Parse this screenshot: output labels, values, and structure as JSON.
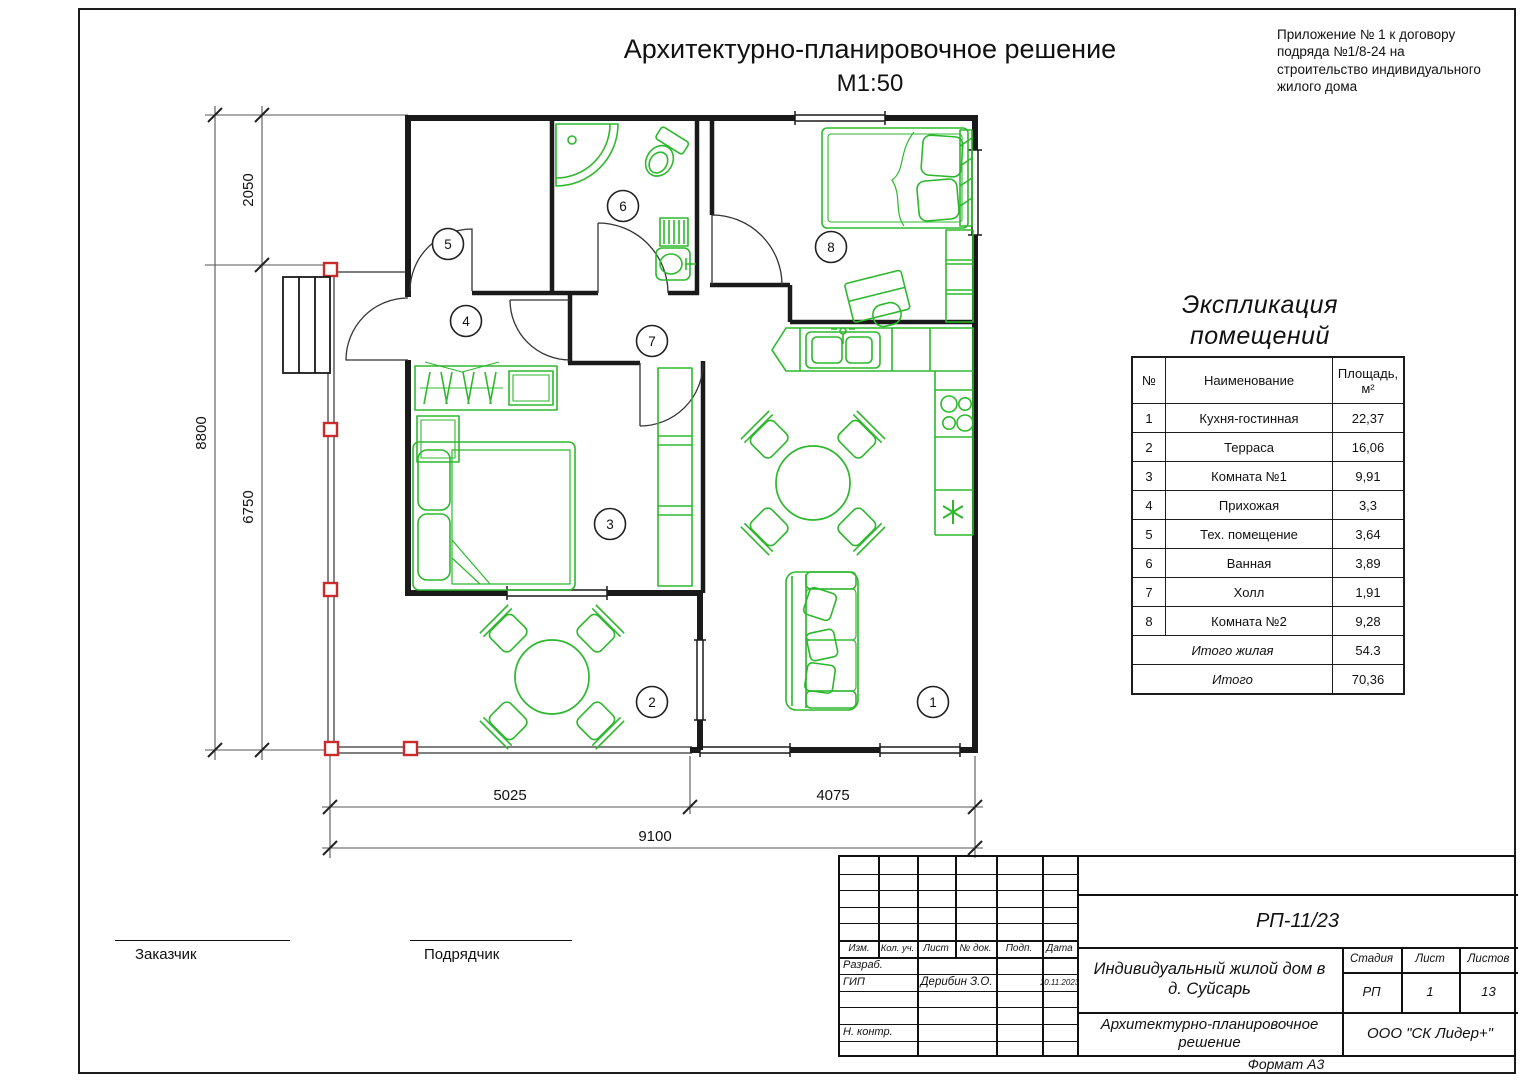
{
  "header": {
    "title": "Архитектурно-планировочное решение",
    "scale": "М1:50",
    "appendix_lines": [
      "Приложение № 1 к договору",
      "подряда №1/8-24  на",
      "строительство индивидуального",
      "жилого дома"
    ]
  },
  "plan": {
    "room_labels": [
      "1",
      "2",
      "3",
      "4",
      "5",
      "6",
      "7",
      "8"
    ],
    "dims": {
      "total_height": "8800",
      "upper": "2050",
      "lower": "6750",
      "bottom_left": "5025",
      "bottom_right": "4075",
      "bottom_total": "9100"
    },
    "colors": {
      "walls": "#1a1a1a",
      "furniture": "#2db82d",
      "posts": "#cc2a2a"
    }
  },
  "explication": {
    "title_lines": [
      "Экспликация",
      "помещений"
    ],
    "headers": {
      "num": "№",
      "name": "Наименование",
      "area1": "Площадь,",
      "area2": "м²"
    },
    "rows": [
      {
        "num": "1",
        "name": "Кухня-гостинная",
        "area": "22,37"
      },
      {
        "num": "2",
        "name": "Терраса",
        "area": "16,06"
      },
      {
        "num": "3",
        "name": "Комната №1",
        "area": "9,91"
      },
      {
        "num": "4",
        "name": "Прихожая",
        "area": "3,3"
      },
      {
        "num": "5",
        "name": "Тех. помещение",
        "area": "3,64"
      },
      {
        "num": "6",
        "name": "Ванная",
        "area": "3,89"
      },
      {
        "num": "7",
        "name": "Холл",
        "area": "1,91"
      },
      {
        "num": "8",
        "name": "Комната №2",
        "area": "9,28"
      }
    ],
    "totals": [
      {
        "name": "Итого жилая",
        "area": "54.3"
      },
      {
        "name": "Итого",
        "area": "70,36"
      }
    ]
  },
  "signature": {
    "customer": "Заказчик",
    "contractor": "Подрядчик"
  },
  "stamp": {
    "doc_number": "РП-11/23",
    "col_headers": [
      "Изм.",
      "Кол. уч.",
      "Лист",
      "№ док.",
      "Подп.",
      "Дата"
    ],
    "row_developer": "Разраб.",
    "row_chief": "ГИП",
    "row_control": "Н. контр.",
    "chief_name": "Дерибин З.О.",
    "date": "10.11.2023",
    "project": "Индивидуальный жилой дом в д. Суйсарь",
    "drawing_title": "Архитектурно-планировочное решение",
    "stage_label": "Стадия",
    "sheet_label": "Лист",
    "sheets_label": "Листов",
    "stage": "РП",
    "sheet_num": "1",
    "sheets_total": "13",
    "company": "ООО \"СК Лидер+\"",
    "format": "Формат А3"
  }
}
